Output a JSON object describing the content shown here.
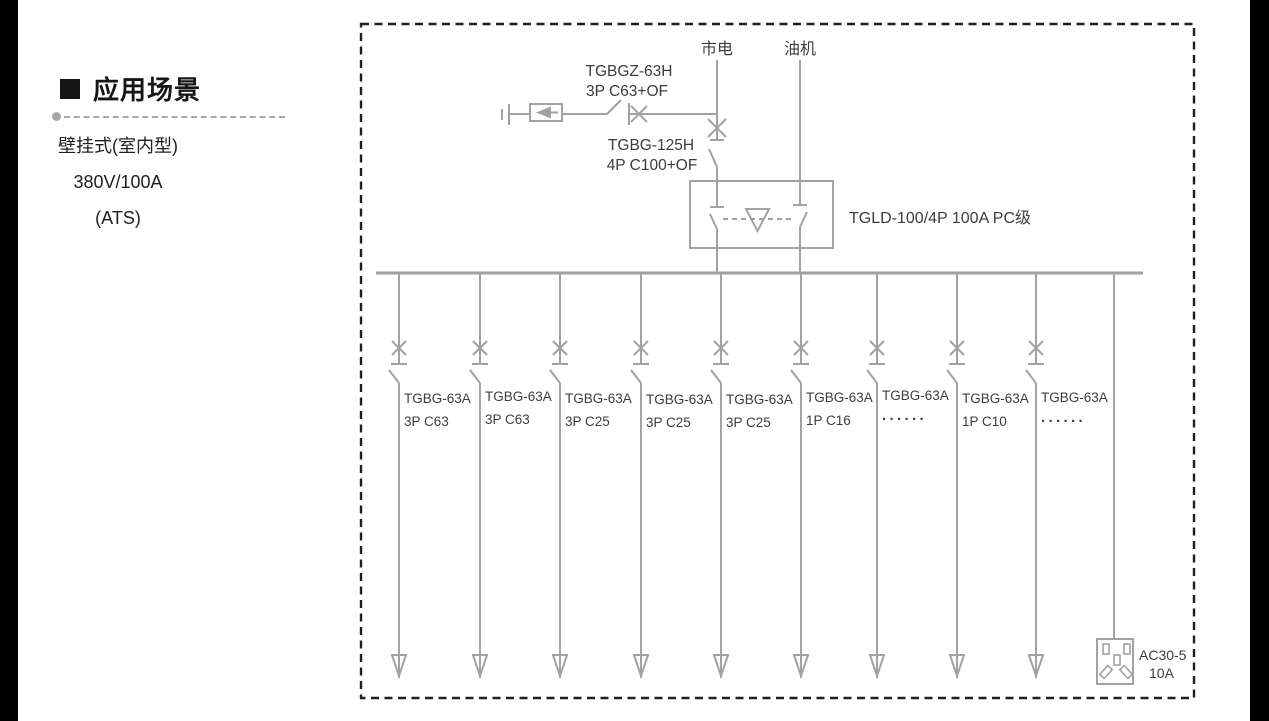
{
  "left_panel": {
    "heading": "应用场景",
    "line1": "壁挂式(室内型)",
    "line2": "380V/100A",
    "line3": "(ATS)"
  },
  "diagram": {
    "mains_label": "市电",
    "generator_label": "油机",
    "spd_breaker_model": "TGBGZ-63H",
    "spd_breaker_spec": "3P C63+OF",
    "main_breaker_model": "TGBG-125H",
    "main_breaker_spec": "4P C100+OF",
    "ats_label": "TGLD-100/4P 100A PC级",
    "branches": [
      {
        "model": "TGBG-63A",
        "spec": "3P C63"
      },
      {
        "model": "TGBG-63A",
        "spec": "3P C63"
      },
      {
        "model": "TGBG-63A",
        "spec": "3P C25"
      },
      {
        "model": "TGBG-63A",
        "spec": "3P C25"
      },
      {
        "model": "TGBG-63A",
        "spec": "3P C25"
      },
      {
        "model": "TGBG-63A",
        "spec": "1P C16"
      },
      {
        "model": "TGBG-63A",
        "spec": "······"
      },
      {
        "model": "TGBG-63A",
        "spec": "1P C10"
      },
      {
        "model": "TGBG-63A",
        "spec": "······"
      }
    ],
    "socket_model": "AC30-5",
    "socket_rating": "10A"
  },
  "colors": {
    "line_gray": "#a2a2a2",
    "text_dark": "#3c3c3c",
    "border_dark": "#1f1f1f",
    "side_bars": "#000000"
  }
}
